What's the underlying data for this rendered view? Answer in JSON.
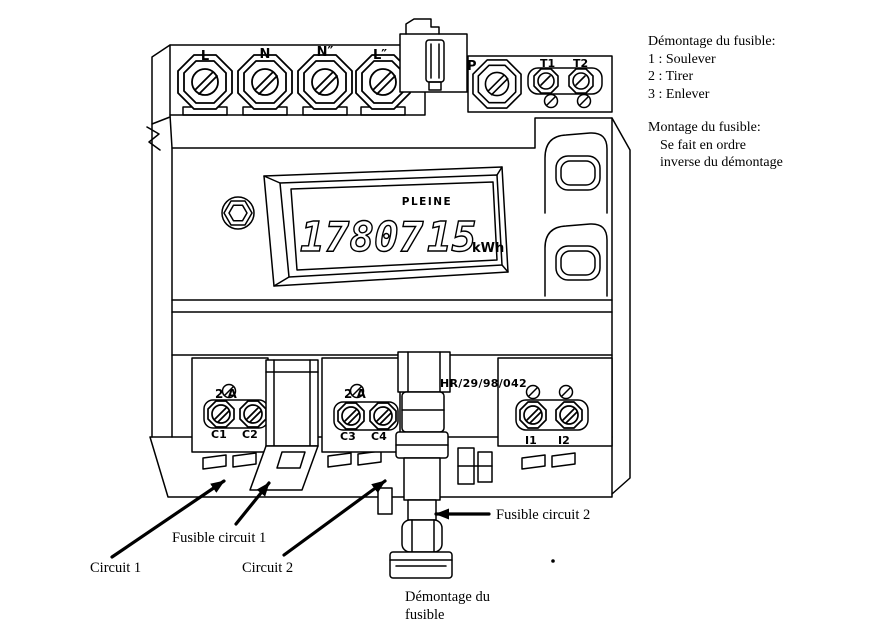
{
  "meter": {
    "lcd": {
      "flag": "PLEINE",
      "value": "1780715",
      "value_part1": "17807",
      "value_part2": "15",
      "unit": "kWh"
    },
    "top_terminals": {
      "t1": "L",
      "t2": "N",
      "t3": "N″",
      "t4": "L″"
    },
    "aux": {
      "p": "P",
      "t1": "T1",
      "t2": "T2"
    },
    "circuits": {
      "module1": {
        "rating": "2 A",
        "left": "C1",
        "right": "C2"
      },
      "module2": {
        "rating": "2 A",
        "left": "C3",
        "right": "C4"
      },
      "module3": {
        "left": "I1",
        "right": "I2"
      }
    },
    "marking": "HR/29/98/042"
  },
  "callouts": {
    "circuit1": "Circuit 1",
    "fuse1": "Fusible circuit 1",
    "circuit2": "Circuit 2",
    "fuse2": "Fusible circuit 2",
    "removal_line1": "Démontage du",
    "removal_line2": "fusible"
  },
  "instructions": {
    "removal_title": "Démontage du fusible:",
    "steps": [
      "1 : Soulever",
      "2 : Tirer",
      "3 : Enlever"
    ],
    "mount_title": "Montage du fusible:",
    "mount_lines": [
      "Se fait en ordre",
      "inverse du démontage"
    ]
  },
  "colors": {
    "ink": "#000000",
    "paper": "#ffffff"
  }
}
